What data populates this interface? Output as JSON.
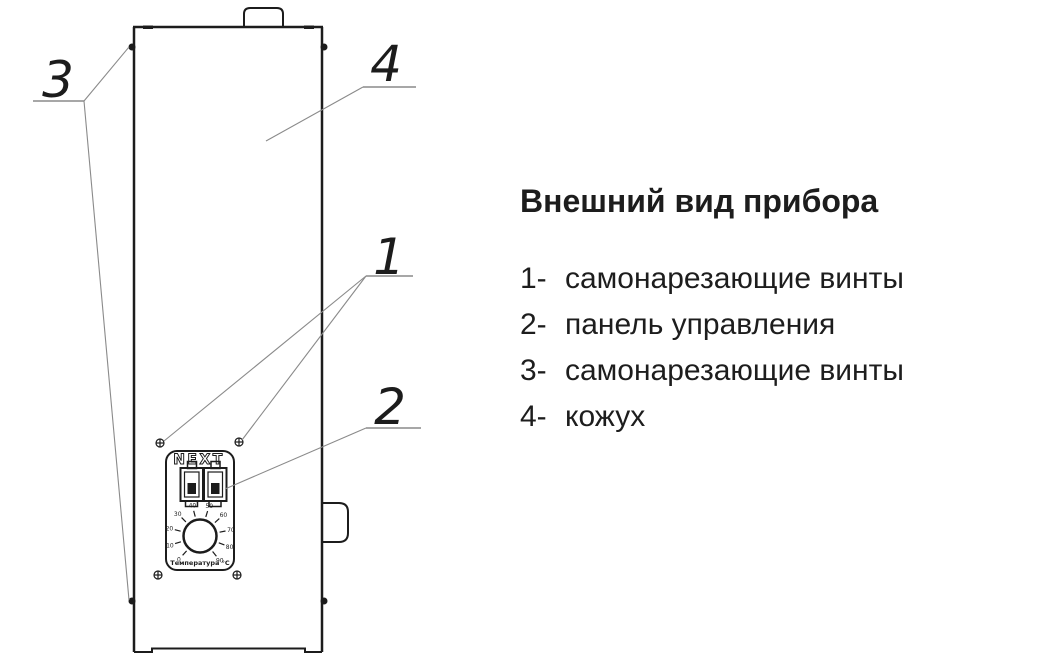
{
  "legend": {
    "title": "Внешний вид прибора",
    "items": [
      {
        "num": "1-",
        "label": "самонарезающие винты"
      },
      {
        "num": "2-",
        "label": "панель управления"
      },
      {
        "num": "3-",
        "label": "самонарезающие винты"
      },
      {
        "num": "4-",
        "label": "кожух"
      }
    ]
  },
  "diagram": {
    "callouts": {
      "c1": "1",
      "c2": "2",
      "c3": "3",
      "c4": "4"
    },
    "panel": {
      "brand": "NEXT",
      "dial": {
        "labels": [
          "0",
          "10",
          "20",
          "30",
          "40",
          "50",
          "60",
          "70",
          "80",
          "90"
        ],
        "caption": "Температура °C"
      }
    },
    "colors": {
      "line": "#1c1c1c",
      "leader": "#8a8a8a",
      "text": "#1d1d1d"
    }
  }
}
